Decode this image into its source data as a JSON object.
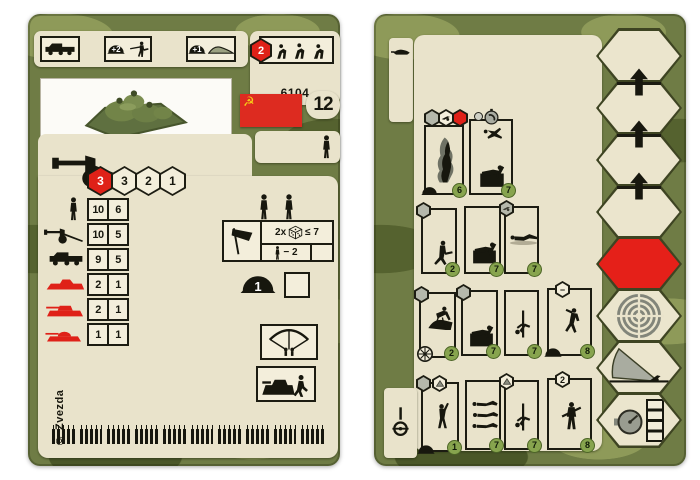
{
  "left_card": {
    "code": "6104",
    "strength": "12",
    "header": {
      "transport_icon": "truck-icon",
      "cover_bonuses": [
        {
          "label": "+2"
        },
        {
          "label": "+1"
        }
      ],
      "crew_hex": "2"
    },
    "flag": {
      "country": "ussr",
      "field": "#dd2b20",
      "emblem": "#f7d117",
      "symbol": "☭"
    },
    "movement_hexes": [
      "3",
      "3",
      "2",
      "1"
    ],
    "attack_table": [
      {
        "target": "infantry",
        "values": [
          "10",
          "6"
        ]
      },
      {
        "target": "field-gun",
        "values": [
          "10",
          "5"
        ]
      },
      {
        "target": "truck",
        "values": [
          "9",
          "5"
        ]
      },
      {
        "target": "armored-car",
        "values": [
          "2",
          "1"
        ]
      },
      {
        "target": "light-tank",
        "values": [
          "2",
          "1"
        ]
      },
      {
        "target": "heavy-tank",
        "values": [
          "1",
          "1"
        ]
      }
    ],
    "assault": {
      "multiplier": "2x",
      "roll": "≤ 7",
      "penalty": "− 2"
    },
    "helmet_value": "1",
    "copyright": "© Zvezda",
    "ammo": {
      "groups": 10,
      "per_group": 5
    },
    "colors": {
      "camo_base": "#6f7c45",
      "cream": "#e9e3cb",
      "red": "#df2118",
      "badge_green": "#87a44e"
    }
  },
  "right_card": {
    "groups": [
      {
        "boxes": [
          {
            "badge": "6"
          },
          {
            "badge": "7"
          }
        ]
      },
      {
        "boxes": [
          {
            "badge": "2"
          },
          {
            "badge": "7"
          },
          {
            "badge": "7"
          }
        ]
      },
      {
        "boxes": [
          {
            "badge": "2"
          },
          {
            "badge": "7"
          },
          {
            "badge": "7"
          },
          {
            "badge": "8",
            "hex": "−"
          }
        ]
      },
      {
        "boxes": [
          {
            "badge": "1"
          },
          {
            "badge": "7"
          },
          {
            "badge": "7"
          },
          {
            "badge": "8",
            "hex": "2"
          }
        ]
      }
    ],
    "hex_column": [
      "blank",
      "blank",
      "blank",
      "blank",
      "red",
      "target",
      "fire-arc",
      "timer"
    ]
  }
}
